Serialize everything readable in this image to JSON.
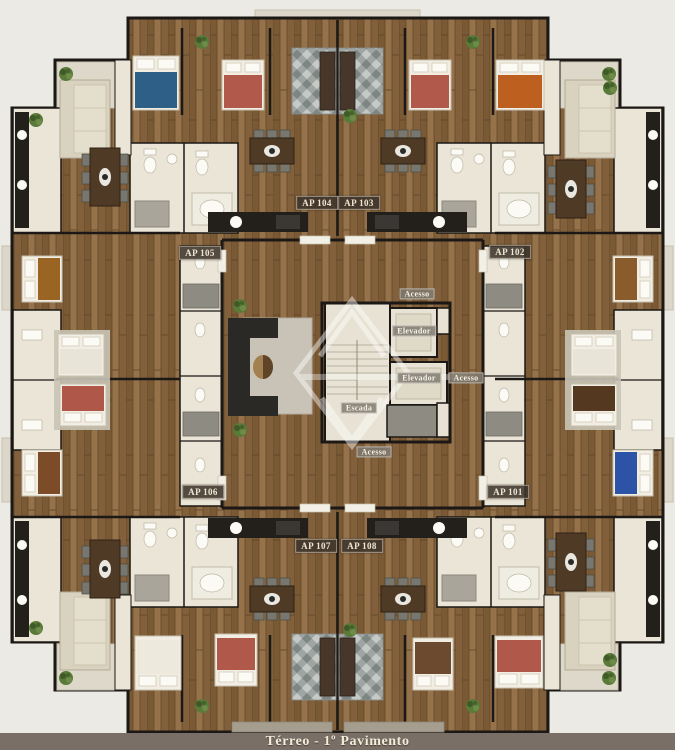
{
  "floorplan": {
    "caption": "Térreo - 1º Pavimento",
    "apartments": [
      {
        "id": "ap-101",
        "label": "AP 101"
      },
      {
        "id": "ap-102",
        "label": "AP 102"
      },
      {
        "id": "ap-103",
        "label": "AP 103"
      },
      {
        "id": "ap-104",
        "label": "AP 104"
      },
      {
        "id": "ap-105",
        "label": "AP 105"
      },
      {
        "id": "ap-106",
        "label": "AP 106"
      },
      {
        "id": "ap-107",
        "label": "AP 107"
      },
      {
        "id": "ap-108",
        "label": "AP 108"
      }
    ],
    "core": {
      "access_top": "Acesso",
      "access_right": "Acesso",
      "access_bottom": "Acesso",
      "elevator_1": "Elevador",
      "elevator_2": "Elevador",
      "stairs": "Escada"
    },
    "colors": {
      "background": "#ECEAE4",
      "wood": "#8A6742",
      "wall": "#1B1815",
      "room_cream": "#EAE5D6",
      "caption_bar": "#796F66",
      "bed_blue": "#2E5F86",
      "bed_red": "#B15A4B",
      "bed_orange": "#BC5F1F",
      "bed_brown": "#9A6423",
      "bed_navy": "#2D53A6"
    }
  }
}
